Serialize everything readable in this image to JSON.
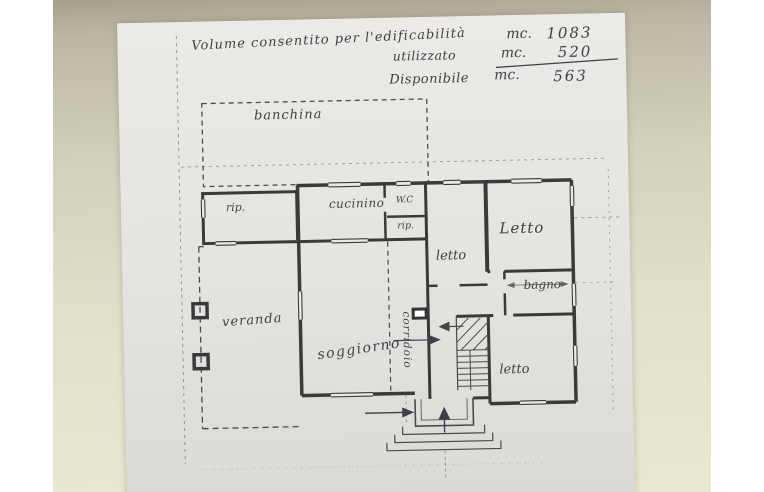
{
  "annotation": {
    "line1": {
      "label": "Volume consentito per l'edificabilità",
      "unit": "mc.",
      "value": "1083"
    },
    "line2": {
      "label": "utilizzato",
      "unit": "mc.",
      "value": "520"
    },
    "line3": {
      "label": "Disponibile",
      "unit": "mc.",
      "value": "563"
    }
  },
  "rooms": {
    "banchina": "banchina",
    "rip_annex": "rip.",
    "cucinino": "cucinino",
    "wc": "W.C",
    "rip_small": "rip.",
    "letto_middle": "letto",
    "letto_right": "Letto",
    "bagno": "bagno",
    "letto_bottom": "letto",
    "soggiorno": "soggiorno",
    "corridoio": "corridoio",
    "veranda": "veranda"
  },
  "colors": {
    "photo_background_top": "#a59f8b",
    "photo_background_bottom": "#eae8d0",
    "paper": "#e7e6e4",
    "ink": "#3f3f49",
    "plan_line": "#3a3a3a",
    "page_margin": "#ffffff"
  }
}
